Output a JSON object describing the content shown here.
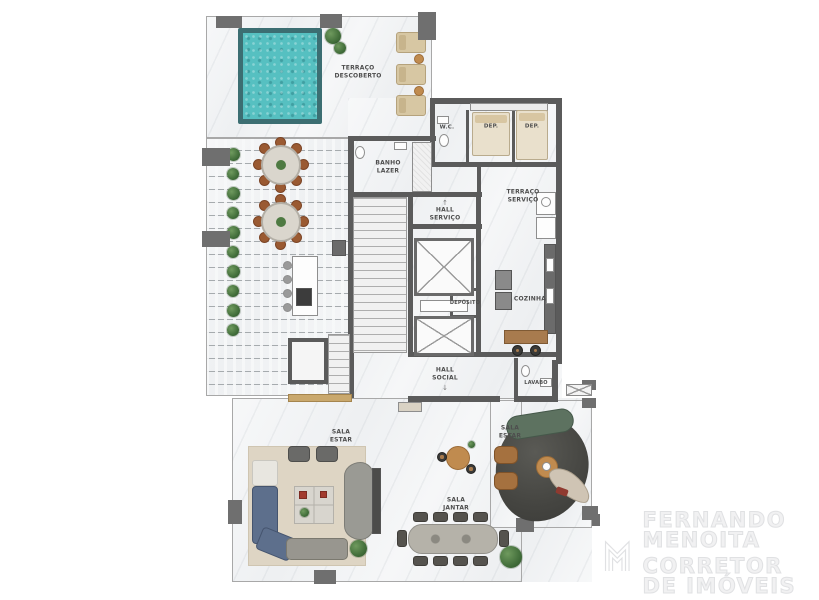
{
  "rooms": {
    "terraco_descoberto": "TERRAÇO\nDESCOBERTO",
    "wc": "W.C.",
    "dep_1": "DEP.",
    "dep_2": "DEP.",
    "banho_lazer": "BANHO\nLAZER",
    "terraco_servico": "TERRAÇO\nSERVIÇO",
    "hall_servico": "HALL\nSERVIÇO",
    "deposito": "DEPÓSITO",
    "cozinha": "COZINHA",
    "hall_social": "HALL\nSOCIAL",
    "lavabo": "LAVABO",
    "sala_estar_left": "SALA\nESTAR",
    "sala_jantar": "SALA\nJANTAR",
    "sala_estar_right": "SALA\nESTAR"
  },
  "icons": {
    "entry_arrow_up": "↑",
    "entry_arrow_down": "↓"
  },
  "logo": {
    "line1": "FERNANDO",
    "line2": "MENOITA",
    "tagline": "CORRETOR DE IMÓVEIS"
  },
  "colors": {
    "pool_water": "#56c0c1",
    "pool_edge": "#3c6e72",
    "wall": "#5b5b5b",
    "column": "#6f6f6f",
    "wood": "#a87b4e",
    "sofa_blue": "#5d6f8c",
    "plant_green": "#3f6b38",
    "logo_gray": "#e3e4e5"
  }
}
